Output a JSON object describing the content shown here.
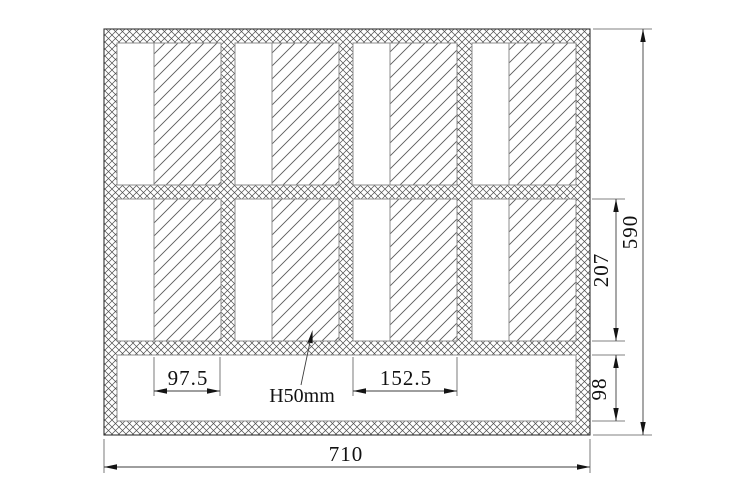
{
  "drawing": {
    "dims": {
      "total_width": "710",
      "total_height": "590",
      "cell_row_height": "207",
      "bottom_strip_height": "98",
      "core_panel_width": "97.5",
      "cell_width": "152.5"
    },
    "leader": {
      "label": "H50mm"
    },
    "structure": {
      "grid_rows": 2,
      "grid_columns": 4,
      "bottom_strip": "empty"
    }
  },
  "colors": {
    "background": "#ffffff",
    "outline": "#333333",
    "crosshatch": "#4d4d4d",
    "core_hatch": "#5a5a5a",
    "dimension_line": "#3c3c3c",
    "text": "#111111"
  }
}
